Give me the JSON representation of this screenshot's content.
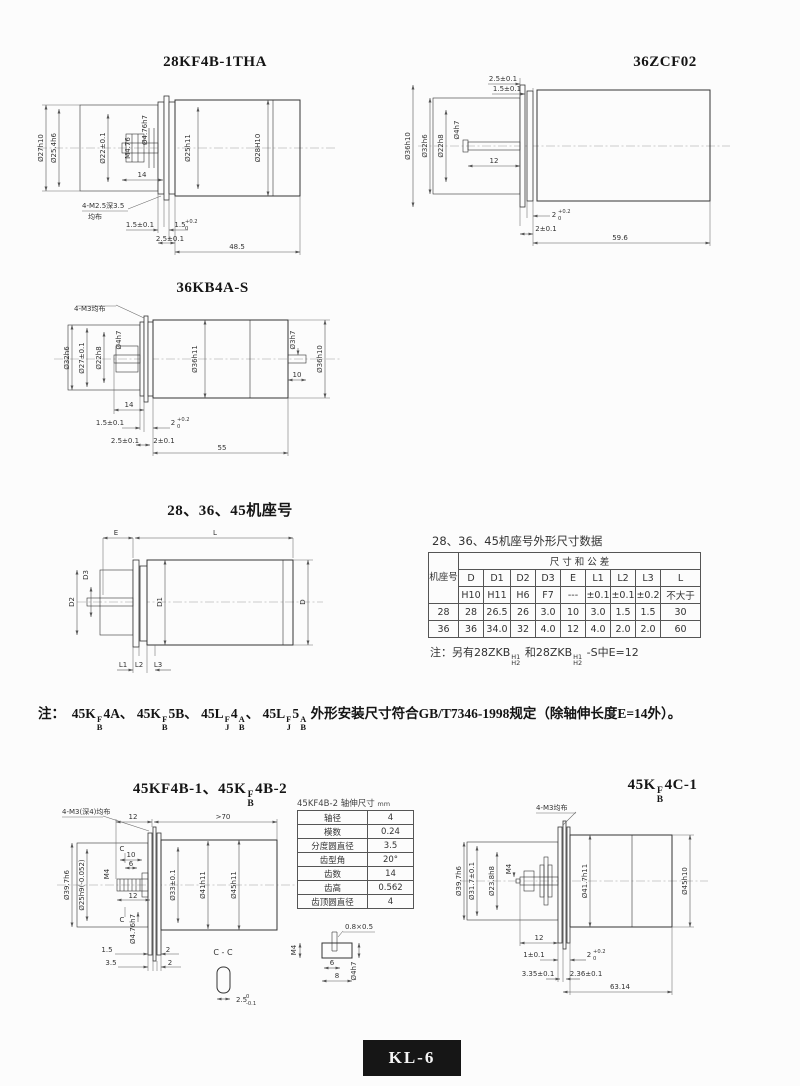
{
  "colors": {
    "line": "#333333",
    "footer_bg": "#161616"
  },
  "d1": {
    "title": "28KF4B-1THA",
    "od": "Ø27h10",
    "flange": "Ø25.4h6",
    "pilot": "Ø22±0.1",
    "thread": "M4.76",
    "shaft": "Ø4.76h7",
    "gear": "Ø25h11",
    "body": "Ø28H10",
    "len14": "14",
    "screws": "4-M2.5深3.5",
    "screws2": "均布",
    "t1": "1.5±0.1",
    "t2v": "1.5",
    "t2sup": "+0.2",
    "t2sub": "0",
    "t3": "2.5±0.1",
    "len": "48.5"
  },
  "d2": {
    "title": "36ZCF02",
    "t1": "2.5±0.1",
    "t2": "1.5±0.1",
    "od": "Ø36h10",
    "flange": "Ø32h6",
    "pilot": "Ø22h8",
    "shaft": "Ø4h7",
    "len12": "12",
    "b1v": "2",
    "b1sup": "+0.2",
    "b1sub": "0",
    "b2": "2±0.1",
    "len": "59.6"
  },
  "d3": {
    "title": "36KB4A-S",
    "screws": "4-M3均布",
    "flange": "Ø32h6",
    "pcd": "Ø27±0.1",
    "pilot": "Ø22h8",
    "shaft": "Ø4h7",
    "gear": "Ø36h11",
    "rshaft": "Ø3h7",
    "body": "Ø36h10",
    "len14": "14",
    "rlen": "10",
    "t1": "1.5±0.1",
    "t2v": "2",
    "t2sup": "+0.2",
    "t2sub": "0",
    "t3": "2.5±0.1",
    "t4": "2±0.1",
    "len": "55"
  },
  "d4": {
    "title": "28、36、45机座号",
    "E": "E",
    "L": "L",
    "D3": "D3",
    "D2": "D2",
    "D1": "D1",
    "D": "D",
    "L1": "L1",
    "L2": "L2",
    "L3": "L3"
  },
  "table1": {
    "title": "28、36、45机座号外形尺寸数据",
    "corner": "机座号",
    "span": "尺 寸 和 公 差",
    "cols": [
      "D",
      "D1",
      "D2",
      "D3",
      "E",
      "L1",
      "L2",
      "L3",
      "L"
    ],
    "tols": [
      "H10",
      "H11",
      "H6",
      "F7",
      "---",
      "±0.1",
      "±0.1",
      "±0.2",
      "不大于"
    ],
    "rows": [
      [
        "28",
        "28",
        "26.5",
        "26",
        "3.0",
        "10",
        "3.0",
        "1.5",
        "1.5",
        "30"
      ],
      [
        "36",
        "36",
        "34.0",
        "32",
        "4.0",
        "12",
        "4.0",
        "2.0",
        "2.0",
        "60"
      ]
    ],
    "note": {
      "p1": "注：另有28ZKB",
      "f1t": "H1",
      "f1b": "H2",
      "p2": "和28ZKB",
      "f2t": "H1",
      "f2b": "H2",
      "p3": "-S中E=12"
    }
  },
  "note": {
    "prefix": "注：",
    "p1": "45K",
    "f1t": "F",
    "f1b": "B",
    "p2": "4A、",
    "p3": "45K",
    "f2t": "F",
    "f2b": "B",
    "p4": "5B、",
    "p5": "45L",
    "f3t": "F",
    "f3b": "J",
    "p6": "4",
    "f4t": "A",
    "f4b": "B",
    "p7": "、",
    "p8": "45L",
    "f5t": "F",
    "f5b": "J",
    "p9": "5",
    "f6t": "A",
    "f6b": "B",
    "p10": "  外形安装尺寸符合GB/T7346-1998规定（除轴伸长度E=14外）。"
  },
  "d5": {
    "title_p1": "45KF4B-1、45K",
    "title_ft": "F",
    "title_fb": "B",
    "title_p2": "4B-2",
    "screws": "4-M3(深4)均布",
    "top12": "12",
    "top70": ">70",
    "od": "Ø39.7h6",
    "hub": "Ø25h9(-0.052)",
    "m4": "M4",
    "d10": "10",
    "d6": "6",
    "d12": "12",
    "shaft": "Ø4.76h7",
    "g1": "Ø33±0.1",
    "g2": "Ø41h11",
    "body": "Ø45h11",
    "b1": "1.5",
    "b2": "2",
    "b3": "3.5",
    "b4": "2",
    "c1": "C",
    "c2": "C",
    "cc": "C - C",
    "ccv": "2.5",
    "ccsup": "0",
    "ccsub": "-0.1",
    "slot": "0.8×0.5",
    "km4": "M4",
    "k6": "6",
    "k8": "8",
    "kdia": "Ø4h7",
    "table": {
      "title": "45KF4B-2 轴伸尺寸",
      "unit": "mm",
      "rows": [
        [
          "轴径",
          "4"
        ],
        [
          "模数",
          "0.24"
        ],
        [
          "分度圆直径",
          "3.5"
        ],
        [
          "齿型角",
          "20°"
        ],
        [
          "齿数",
          "14"
        ],
        [
          "齿高",
          "0.562"
        ],
        [
          "齿顶圆直径",
          "4"
        ]
      ]
    }
  },
  "d6": {
    "title_p1": "45K",
    "title_ft": "F",
    "title_fb": "B",
    "title_p2": "4C-1",
    "screws": "4-M3均布",
    "od": "Ø39.7h6",
    "pcd": "Ø31.7±0.1",
    "pilot": "Ø23.8h8",
    "m4": "M4",
    "gear": "Ø41.7h11",
    "body": "Ø45h10",
    "len12": "12",
    "t1": "1±0.1",
    "tv": "2",
    "tsup": "+0.2",
    "tsub": "0",
    "t3": "3.35±0.1",
    "t4": "2.36±0.1",
    "len": "63.14"
  },
  "footer": {
    "label": "KL-6"
  }
}
